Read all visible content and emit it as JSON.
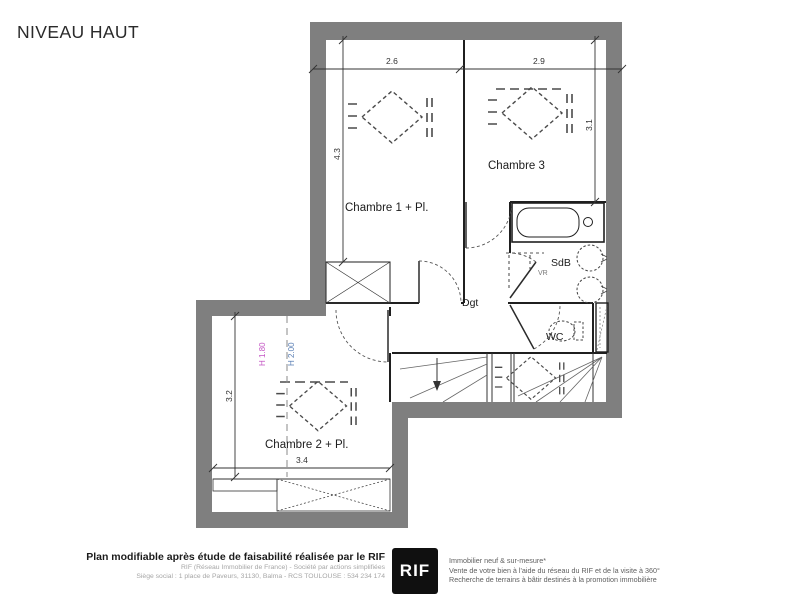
{
  "title": "NIVEAU HAUT",
  "plan": {
    "rooms": {
      "chambre1": "Chambre 1 + Pl.",
      "chambre3": "Chambre 3",
      "sdb": "SdB",
      "dgt": "Dgt",
      "wc": "WC",
      "chambre2": "Chambre 2 + Pl."
    },
    "annotations": {
      "vr": "VR"
    },
    "dimensions": {
      "chambre1_width": "2.6",
      "chambre3_width": "2.9",
      "chambre1_depth": "4.3",
      "chambre3_depth": "3.1",
      "chambre2_depth": "3.2",
      "chambre2_width": "3.4"
    },
    "heights": {
      "h180": {
        "label": "H 1.80",
        "color": "#c455c4"
      },
      "h200": {
        "label": "H 2.00",
        "color": "#5a7fb5"
      }
    },
    "colors": {
      "wall": "#7f7f7f",
      "line": "#1f1f1f"
    }
  },
  "footer": {
    "left": {
      "bold": "Plan modifiable après étude de faisabilité réalisée par le RIF",
      "line2": "RIF (Réseau Immobilier de France) - Société par actions simplifiées",
      "line3": "Siège social : 1 place de Paveurs, 31130, Balma - RCS TOULOUSE : 534 234 174"
    },
    "logo": "RIF",
    "right": {
      "line1": "Immobilier neuf & sur-mesure*",
      "line2": "Vente de votre bien à l'aide du réseau du RIF et de la visite à 360°",
      "line3": "Recherche de terrains à bâtir destinés à la promotion immobilière"
    }
  }
}
